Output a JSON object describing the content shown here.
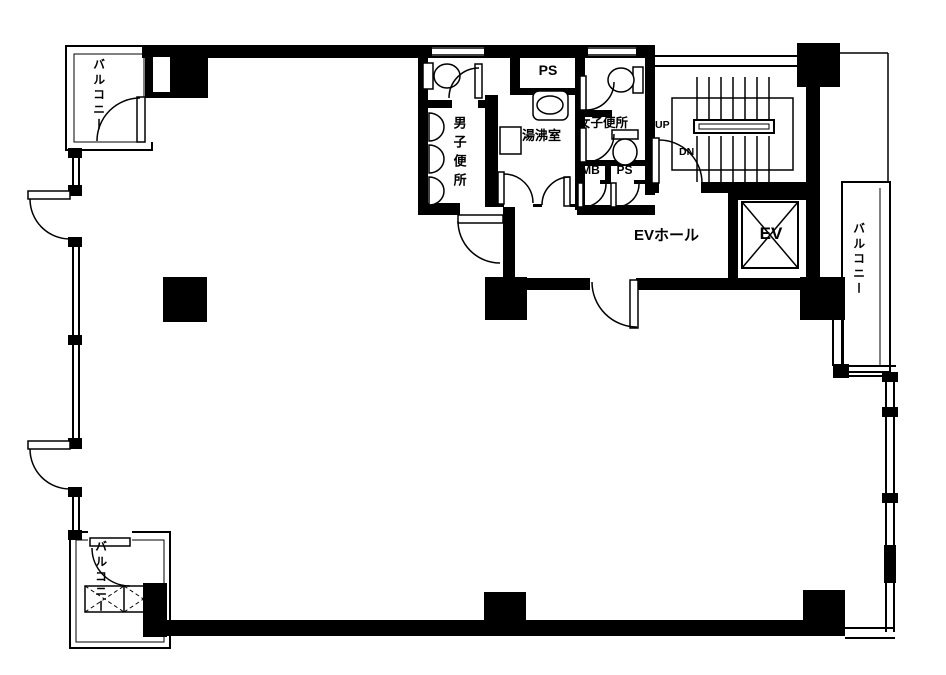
{
  "plan": {
    "type": "japanese-office-floor-plan",
    "colors": {
      "wall": "#000000",
      "background": "#ffffff",
      "line": "#000000"
    },
    "labels": {
      "balcony_top_left": "バルコニー",
      "balcony_bottom_left": "バルコニー",
      "balcony_right": "バルコニー",
      "mens_toilet": "男子便所",
      "kitchenette": "湯沸室",
      "womens_toilet": "女子便所",
      "ps_upper": "PS",
      "mb": "MB",
      "ps_lower": "PS",
      "ev_hall": "EVホール",
      "elevator": "EV",
      "stairs_up": "UP",
      "stairs_down": "DN"
    },
    "icons": {
      "toilet": "toilet-fixture-icon",
      "urinal": "urinal-fixture-icon",
      "sink": "sink-fixture-icon",
      "elevator_cross": "elevator-x-icon",
      "escape_hatch": "escape-hatch-icon",
      "stairs": "stair-treads-icon",
      "door": "door-swing-arc-icon"
    }
  }
}
